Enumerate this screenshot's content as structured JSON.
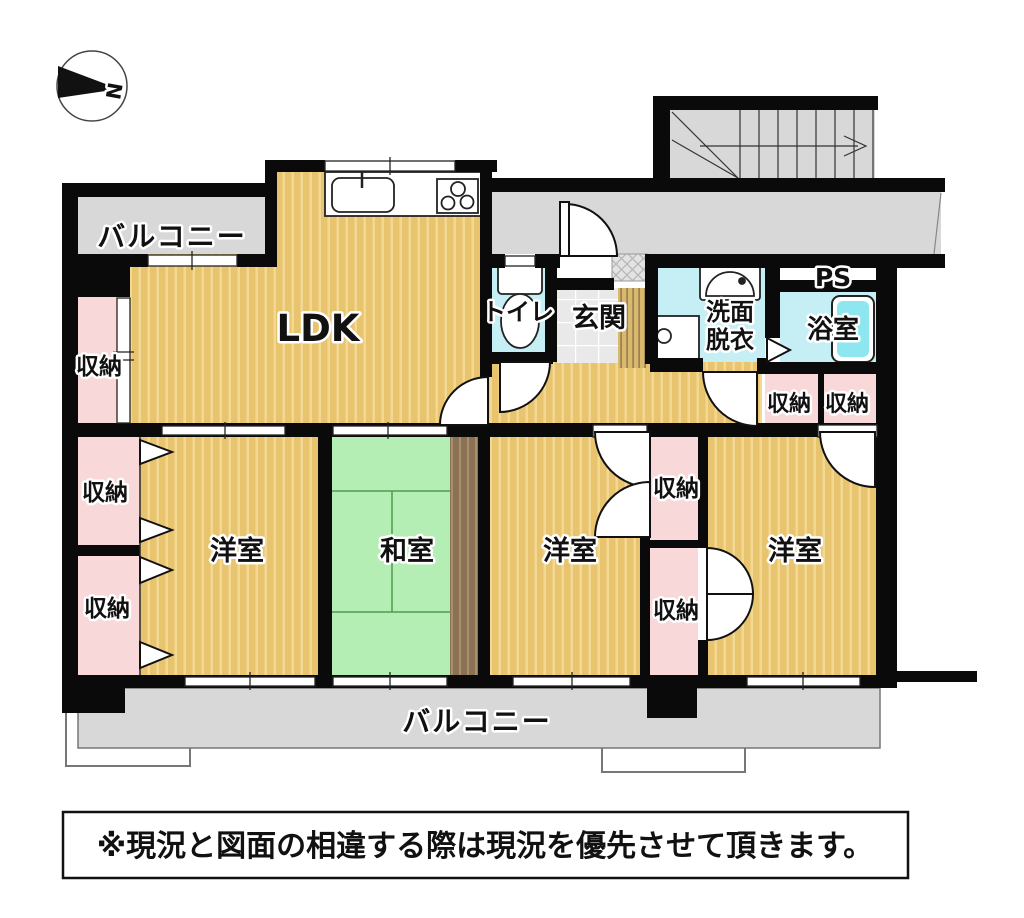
{
  "compass": {
    "north_label": "N"
  },
  "rooms": {
    "balcony_top": "バルコニー",
    "ldk": "LDK",
    "toilet": "トイレ",
    "entrance": "玄関",
    "washroom_line1": "洗面",
    "washroom_line2": "脱衣",
    "bathroom": "浴室",
    "pipe_space": "PS",
    "japanese_room": "和室",
    "western_room_1": "洋室",
    "western_room_2": "洋室",
    "western_room_3": "洋室",
    "balcony_bottom": "バルコニー"
  },
  "storage_labels": [
    "収納",
    "収納",
    "収納",
    "収納",
    "収納",
    "収納",
    "収納"
  ],
  "notice": "※現況と図面の相違する際は現況を優先させて頂きます。",
  "colors": {
    "wall": "#0a0a0a",
    "wood_floor": "#e9c46e",
    "wood_floor_stripe": "#f3d893",
    "tatami": "#b5eeb5",
    "tatami_line": "#4e9a4e",
    "wet_area": "#c6eff5",
    "bathtub": "#8ee7f0",
    "storage": "#f8d8d8",
    "balcony": "#d8d8d8",
    "engawa_brown": "#8c7254",
    "tile": "#e9e9e9"
  }
}
